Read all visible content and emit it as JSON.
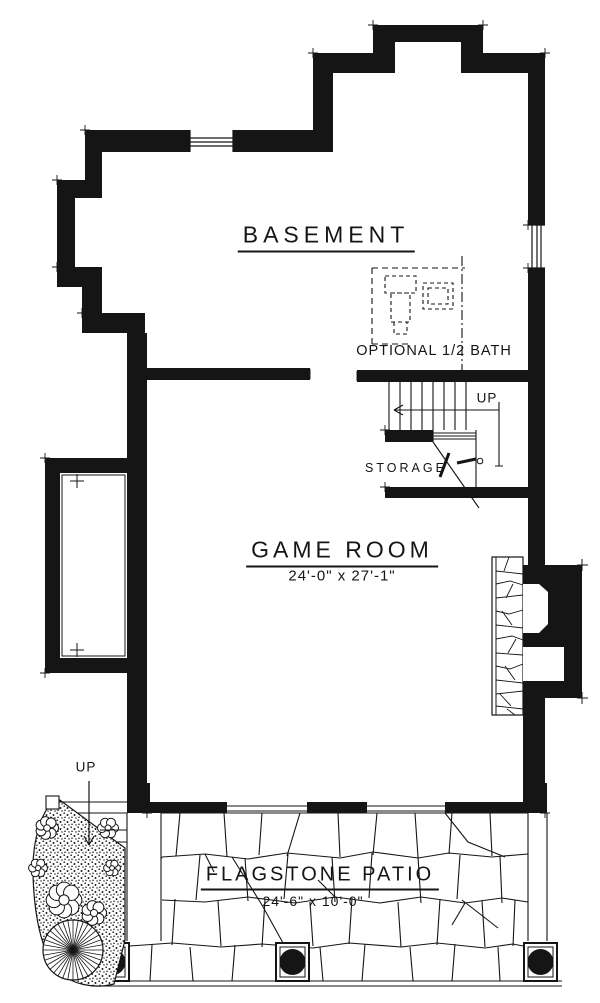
{
  "title": "Basement Floor Plan",
  "colors": {
    "ink": "#151515",
    "paper": "#ffffff"
  },
  "rooms": {
    "basement": {
      "label": "BASEMENT"
    },
    "game_room": {
      "label": "GAME ROOM",
      "dims": "24'-0\" x 27'-1\""
    },
    "optional_bath": {
      "label": "OPTIONAL 1/2 BATH"
    },
    "storage": {
      "label": "STORAGE"
    },
    "patio": {
      "label": "FLAGSTONE PATIO",
      "dims": "24'-6\" x 10'-0\""
    }
  },
  "annotations": {
    "stair_up": "UP",
    "patio_up": "UP"
  }
}
